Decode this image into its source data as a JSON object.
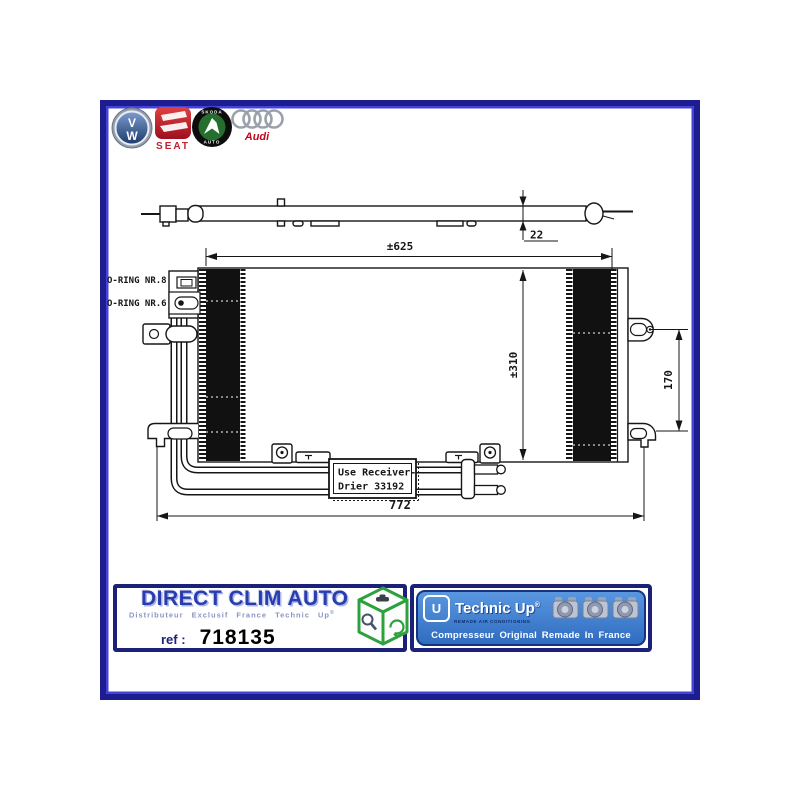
{
  "colors": {
    "frame_navy": "#1d1d8f",
    "frame_inner_blue": "#4343da",
    "banner_navy": "#1b2178",
    "panel_blue": "#3d7fd2",
    "title_blue": "#2b3cae",
    "cube_green": "#2da13c",
    "seat_red": "#c22030",
    "audi_red": "#bb0a1e",
    "line_black": "#161616"
  },
  "logos": {
    "vw_top": "V",
    "vw_bottom": "W",
    "seat": "SEAT",
    "skoda_top": "SKODA",
    "skoda_bottom": "AUTO",
    "audi": "Audi"
  },
  "drawing": {
    "oring_top": "O-RING NR.8",
    "oring_bottom": "O-RING NR.6",
    "dim_depth": "22",
    "dim_width": "±625",
    "dim_height": "±310",
    "dim_bracket": "170",
    "dim_overall": "772",
    "note1": "Use Receiver-",
    "note2": "Drier  33192"
  },
  "banner": {
    "company": "DIRECT CLIM AUTO",
    "subtitle": "Distributeur Exclusif France Technic Up",
    "subtitle_reg": "®",
    "ref_label": "ref :",
    "ref_value": "718135",
    "brand": "Technic Up",
    "brand_reg": "®",
    "brand_sub": "REMADE AIR CONDITIONING",
    "tagline": "Compresseur Original Remade In France"
  }
}
